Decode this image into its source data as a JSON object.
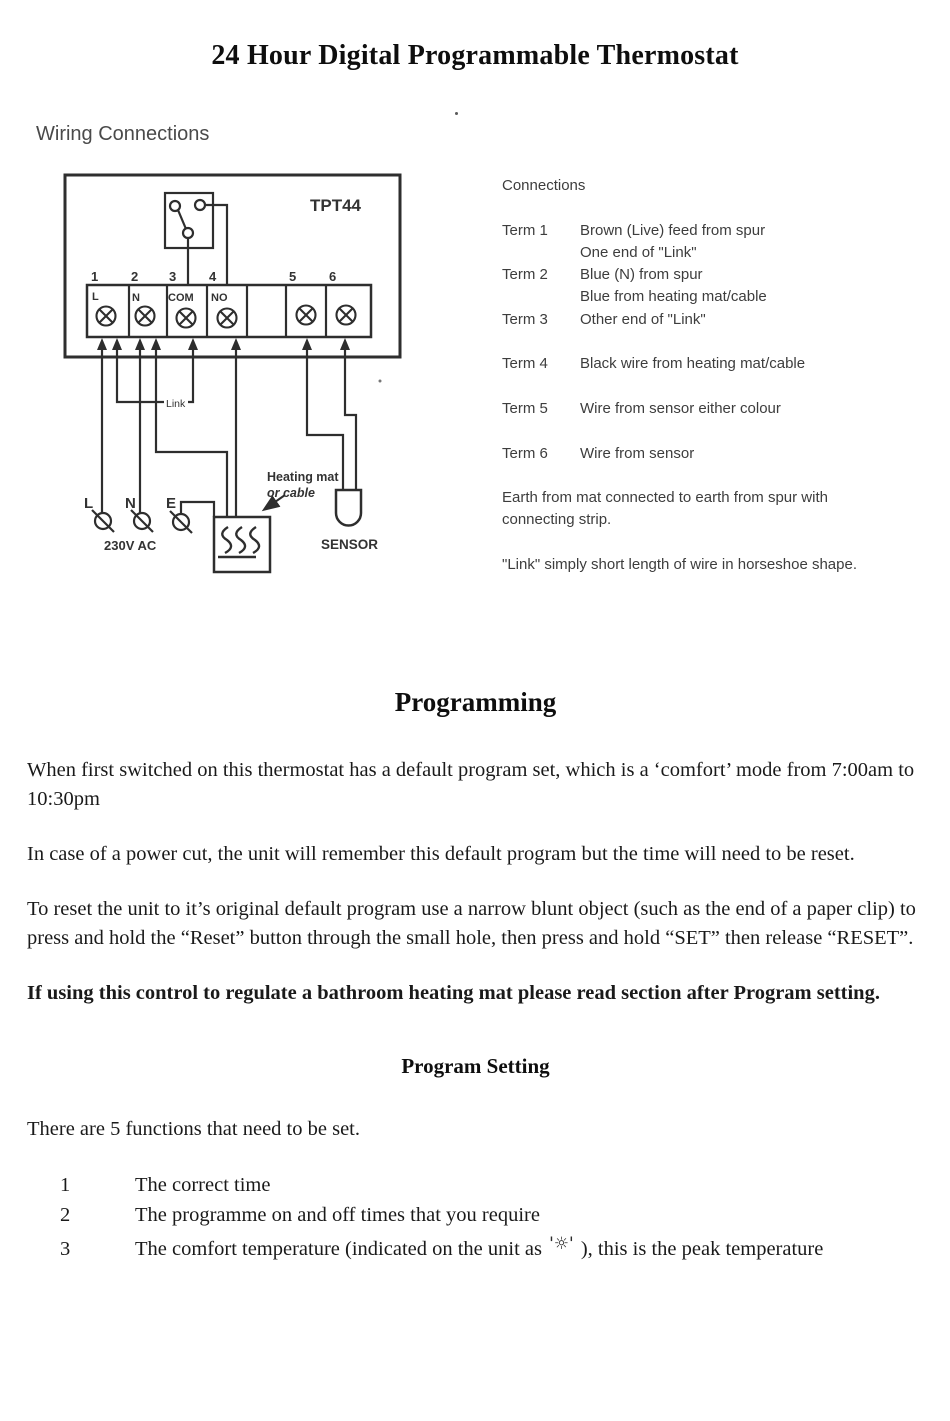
{
  "page": {
    "title": "24 Hour Digital Programmable Thermostat"
  },
  "wiring": {
    "section_title": "Wiring Connections",
    "diagram": {
      "model": "TPT44",
      "terminals": [
        "1",
        "2",
        "3",
        "4",
        "5",
        "6"
      ],
      "terminal_labels": [
        "L",
        "N",
        "COM",
        "NO"
      ],
      "link_label": "Link",
      "supply_live": "L",
      "supply_neutral": "N",
      "supply_earth": "E",
      "voltage": "230V AC",
      "heating_mat_line1": "Heating mat",
      "heating_mat_line2": "or cable",
      "sensor_label": "SENSOR"
    },
    "connections": {
      "heading": "Connections",
      "terms": [
        {
          "label": "Term 1",
          "line1": "Brown (Live) feed from spur",
          "line2": "One end of \"Link\""
        },
        {
          "label": "Term 2",
          "line1": "Blue (N) from spur",
          "line2": "Blue from heating mat/cable"
        },
        {
          "label": "Term 3",
          "line1": "Other end of \"Link\"",
          "line2": ""
        },
        {
          "label": "Term 4",
          "line1": "Black wire from heating mat/cable",
          "line2": ""
        },
        {
          "label": "Term 5",
          "line1": "Wire from sensor either colour",
          "line2": ""
        },
        {
          "label": "Term 6",
          "line1": "Wire from sensor",
          "line2": ""
        }
      ],
      "notes": [
        "Earth from mat connected to earth from spur with connecting strip.",
        "\"Link\" simply short length of wire in horseshoe shape."
      ]
    }
  },
  "programming": {
    "heading": "Programming",
    "paragraphs": [
      "When first switched on this thermostat has a default program set, which is a ‘comfort’ mode from 7:00am to 10:30pm",
      "In case of a power cut, the unit will remember this default program but the time will need to be reset.",
      "To reset the unit to it’s original default program use a narrow blunt object (such as the end of a paper clip) to press and hold the “Reset” button through the small hole, then press and hold “SET” then release “RESET”."
    ],
    "bold_note": "If using this control to regulate a bathroom heating mat please read section after Program setting."
  },
  "program_setting": {
    "heading": "Program Setting",
    "intro": "There are 5 functions that need to be set.",
    "items": [
      {
        "num": "1",
        "text": "The correct time"
      },
      {
        "num": "2",
        "text": "The programme on and off times that you require"
      },
      {
        "num": "3",
        "pre": "The comfort temperature (indicated on the unit as ",
        "symbol": "'☼'",
        "post": " ), this is the peak temperature"
      }
    ]
  }
}
